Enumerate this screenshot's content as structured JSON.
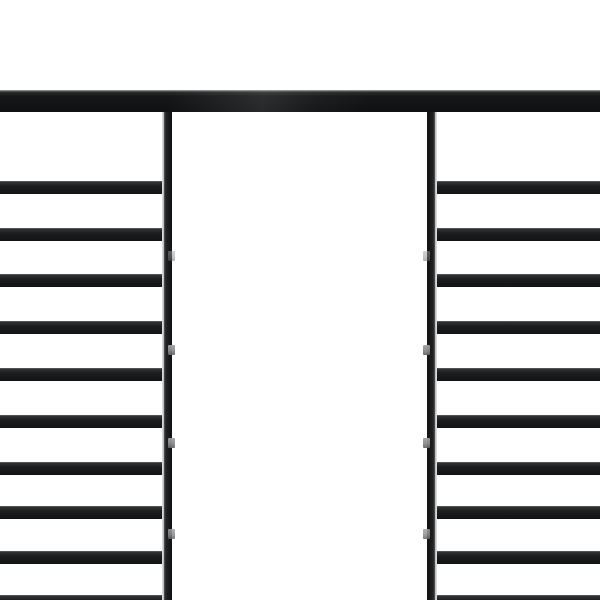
{
  "image": {
    "type": "product-photo",
    "subject": "Close-up of a black steel pergola / gazebo frame: full-width top beam, two vertical support posts, and ladder-style horizontal roof slats on the left and right sides with an open white gap in the center",
    "background_color": "#ffffff"
  },
  "colors": {
    "background": "#ffffff",
    "metal_dark": "#121314",
    "metal_mid": "#1b1d1e",
    "metal_edge_light": "#505254",
    "beam_top_face": "#9a9b9c",
    "post_seam_highlight": "#d2d2d2",
    "bracket_gray": "#8b8c8d"
  },
  "scene": {
    "canvas": {
      "width": 600,
      "height": 600
    },
    "beam": {
      "x": 0,
      "y": 90,
      "width": 600,
      "height": 22
    },
    "posts": {
      "top": 112,
      "bottom": 600,
      "width": 10,
      "left_x": 162,
      "right_x": 427
    },
    "slats": {
      "count_per_side": 10,
      "tops": [
        181,
        228,
        274,
        321,
        368,
        415,
        462,
        506,
        551,
        595
      ],
      "height": 13,
      "left_span": [
        0,
        168
      ],
      "right_span": [
        430,
        600
      ]
    },
    "brackets": {
      "centers_y": [
        256,
        350,
        443,
        534
      ],
      "width": 7,
      "height": 10,
      "left_x": 168,
      "right_x": 423,
      "opacities": [
        0.5,
        0.95,
        0.95,
        0.85
      ]
    }
  }
}
